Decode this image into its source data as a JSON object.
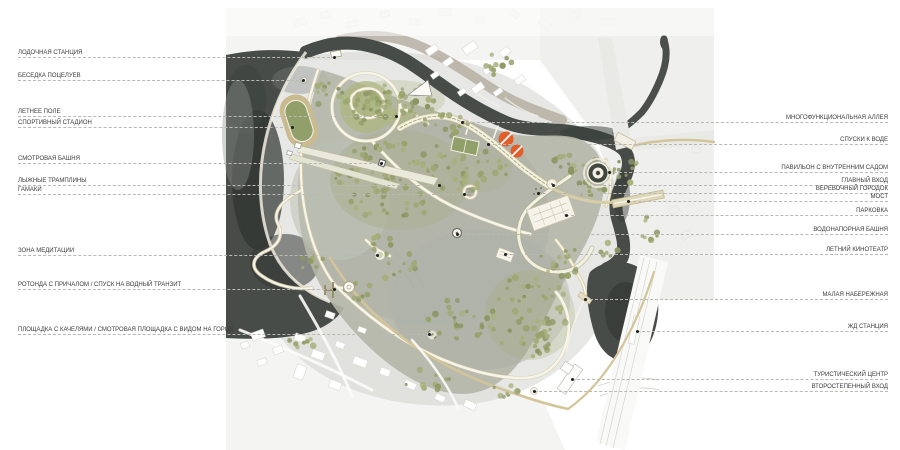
{
  "colors": {
    "page_bg": "#ffffff",
    "label_text": "#3a3a3a",
    "leader_line": "#b9b9b3",
    "leader_dot": "#1f1f1f",
    "water": "#474c48",
    "water_deep": "#2e3330",
    "water_edge": "#8f948f",
    "river_bank": "#b3aa9d",
    "park_ground": "#b4b6a9",
    "tree_olive": "#97a169",
    "tree_sage": "#a8af7a",
    "path_fill": "#f7f4ea",
    "path_edge": "#d6caa5",
    "road_tan": "#d3c49a",
    "city_bg": "#f3f3f1",
    "building": "#ffffff",
    "building_edge": "#d9d9d4",
    "rail_band": "#f9f9f7",
    "field_green": "#91a06b",
    "lawn_green": "#aeb77f",
    "accent_orange": "#e05f2b"
  },
  "callouts": {
    "left_edge_x": 18,
    "right_edge_x": 888,
    "left": [
      {
        "id": "boat-station",
        "label": "ЛОДОЧНАЯ СТАНЦИЯ",
        "line_y": 57,
        "dot_x": 335
      },
      {
        "id": "kissing-gazebo",
        "label": "БЕСЕДКА ПОЦЕЛУЕВ",
        "line_y": 80,
        "dot_x": 304
      },
      {
        "id": "summer-field",
        "label": "ЛЕТНЕЕ ПОЛЕ",
        "line_y": 116,
        "dot_x": 397
      },
      {
        "id": "sports-stadium",
        "label": "СПОРТИВНЫЙ СТАДИОН",
        "line_y": 127,
        "dot_x": 293
      },
      {
        "id": "observation-tower",
        "label": "СМОТРОВАЯ БАШНЯ",
        "line_y": 163,
        "dot_x": 382
      },
      {
        "id": "ski-jumps",
        "label": "ЛЫЖНЫЕ ТРАМПЛИНЫ",
        "line_y": 185,
        "dot_x": 440
      },
      {
        "id": "hammocks",
        "label": "ГАМАКИ",
        "line_y": 194,
        "dot_x": 465
      },
      {
        "id": "meditation-zone",
        "label": "ЗОНА МЕДИТАЦИИ",
        "line_y": 255,
        "dot_x": 378
      },
      {
        "id": "rotunda-pier",
        "label": "РОТОНДА С ПРИЧАЛОМ / СПУСК НА ВОДНЫЙ ТРАНЗИТ",
        "line_y": 289,
        "dot_x": 335
      },
      {
        "id": "swing-overlook",
        "label": "ПЛОЩАДКА С КАЧЕЛЯМИ / СМОТРОВАЯ ПЛОЩАДКА С ВИДОМ НА ГОРОД",
        "line_y": 334,
        "dot_x": 430
      }
    ],
    "right": [
      {
        "id": "multifunctional-alley",
        "label": "МНОГОФУНКЦИОНАЛЬНАЯ АЛЛЕЯ",
        "line_y": 122,
        "dot_x": 462
      },
      {
        "id": "water-descents",
        "label": "СПУСКИ К ВОДЕ",
        "line_y": 144,
        "dot_x": 488
      },
      {
        "id": "pavilion-inner-garden",
        "label": "ПАВИЛЬОН С ВНУТРЕННИМ САДОМ",
        "line_y": 172,
        "dot_x": 609
      },
      {
        "id": "main-entrance",
        "label": "ГЛАВНЫЙ ВХОД",
        "line_y": 185,
        "dot_x": 553
      },
      {
        "id": "rope-park",
        "label": "ВЕРЕВОЧНЫЙ ГОРОДОК",
        "line_y": 193,
        "dot_x": 538
      },
      {
        "id": "bridge",
        "label": "МОСТ",
        "line_y": 201,
        "dot_x": 628
      },
      {
        "id": "parking",
        "label": "ПАРКОВКА",
        "line_y": 215,
        "dot_x": 566
      },
      {
        "id": "water-tower",
        "label": "ВОДОНАПОРНАЯ БАШНЯ",
        "line_y": 234,
        "dot_x": 457
      },
      {
        "id": "summer-cinema",
        "label": "ЛЕТНИЙ КИНОТЕАТР",
        "line_y": 254,
        "dot_x": 505
      },
      {
        "id": "small-embankment",
        "label": "МАЛАЯ НАБЕРЕЖНАЯ",
        "line_y": 299,
        "dot_x": 585
      },
      {
        "id": "railway-station",
        "label": "ЖД СТАНЦИЯ",
        "line_y": 331,
        "dot_x": 637
      },
      {
        "id": "tourist-center",
        "label": "ТУРИСТИЧЕСКИЙ ЦЕНТР",
        "line_y": 379,
        "dot_x": 572
      },
      {
        "id": "secondary-entrance",
        "label": "ВТОРОСТЕПЕННЫЙ ВХОД",
        "line_y": 391,
        "dot_x": 534
      }
    ]
  }
}
